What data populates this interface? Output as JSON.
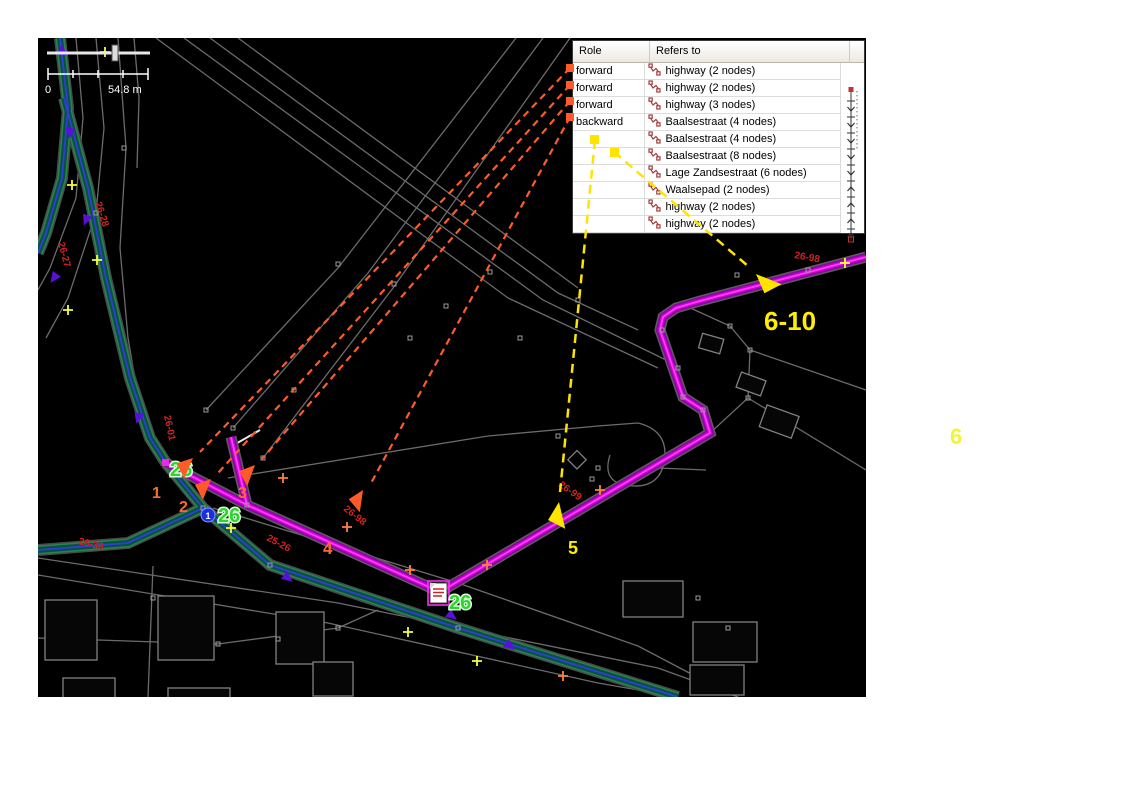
{
  "map_overlay": {
    "scale_zero": "0",
    "scale_distance": "54.8 m"
  },
  "members_panel": {
    "columns": [
      "Role",
      "Refers to"
    ],
    "rows": [
      {
        "role": "forward",
        "refers_to": "highway (2 nodes)"
      },
      {
        "role": "forward",
        "refers_to": "highway (2 nodes)"
      },
      {
        "role": "forward",
        "refers_to": "highway (3 nodes)"
      },
      {
        "role": "backward",
        "refers_to": "Baalsestraat (4 nodes)"
      },
      {
        "role": "",
        "refers_to": "Baalsestraat (4 nodes)"
      },
      {
        "role": "",
        "refers_to": "Baalsestraat (8 nodes)"
      },
      {
        "role": "",
        "refers_to": "Lage Zandsestraat (6 nodes)"
      },
      {
        "role": "",
        "refers_to": "Waalsepad (2 nodes)"
      },
      {
        "role": "",
        "refers_to": "highway (2 nodes)"
      },
      {
        "role": "",
        "refers_to": "highway (2 nodes)"
      }
    ]
  },
  "annotations": {
    "step_labels": [
      {
        "text": "1",
        "x": 114,
        "y": 460,
        "color": "#ff6a2a",
        "size": 16
      },
      {
        "text": "2",
        "x": 141,
        "y": 474,
        "color": "#ff6a2a",
        "size": 16
      },
      {
        "text": "3",
        "x": 200,
        "y": 460,
        "color": "#ff6a2a",
        "size": 16
      },
      {
        "text": "4",
        "x": 285,
        "y": 516,
        "color": "#ff6a2a",
        "size": 17
      },
      {
        "text": "5",
        "x": 530,
        "y": 516,
        "color": "#ffee00",
        "size": 18
      },
      {
        "text": "6-10",
        "x": 726,
        "y": 292,
        "color": "#ffee00",
        "size": 26
      }
    ],
    "outside_label": "6"
  },
  "map_labels": {
    "way_refs": [
      {
        "text": "26-01",
        "x": 126,
        "y": 378,
        "rot": 78
      },
      {
        "text": "26-28",
        "x": 57,
        "y": 165,
        "rot": 72
      },
      {
        "text": "26-27",
        "x": 20,
        "y": 205,
        "rot": 75
      },
      {
        "text": "26-98",
        "x": 305,
        "y": 472,
        "rot": 38
      },
      {
        "text": "25-26",
        "x": 228,
        "y": 502,
        "rot": 28
      },
      {
        "text": "26-36",
        "x": 40,
        "y": 506,
        "rot": 14
      },
      {
        "text": "26-99",
        "x": 520,
        "y": 448,
        "rot": 35
      },
      {
        "text": "26-98",
        "x": 756,
        "y": 220,
        "rot": 10
      }
    ],
    "node_badges": [
      {
        "text": "26",
        "x": 132,
        "y": 438
      },
      {
        "text": "26",
        "x": 180,
        "y": 484
      },
      {
        "text": "26",
        "x": 411,
        "y": 571
      }
    ],
    "junction_node_number": "1"
  },
  "colors": {
    "route_highlight": "#ff2bff",
    "road_teal": "#0d5c50",
    "connector_orange": "#ff5a28",
    "connector_yellow": "#ffe400",
    "badge_green": "#2fd42f",
    "way_label_red": "#d42222"
  }
}
